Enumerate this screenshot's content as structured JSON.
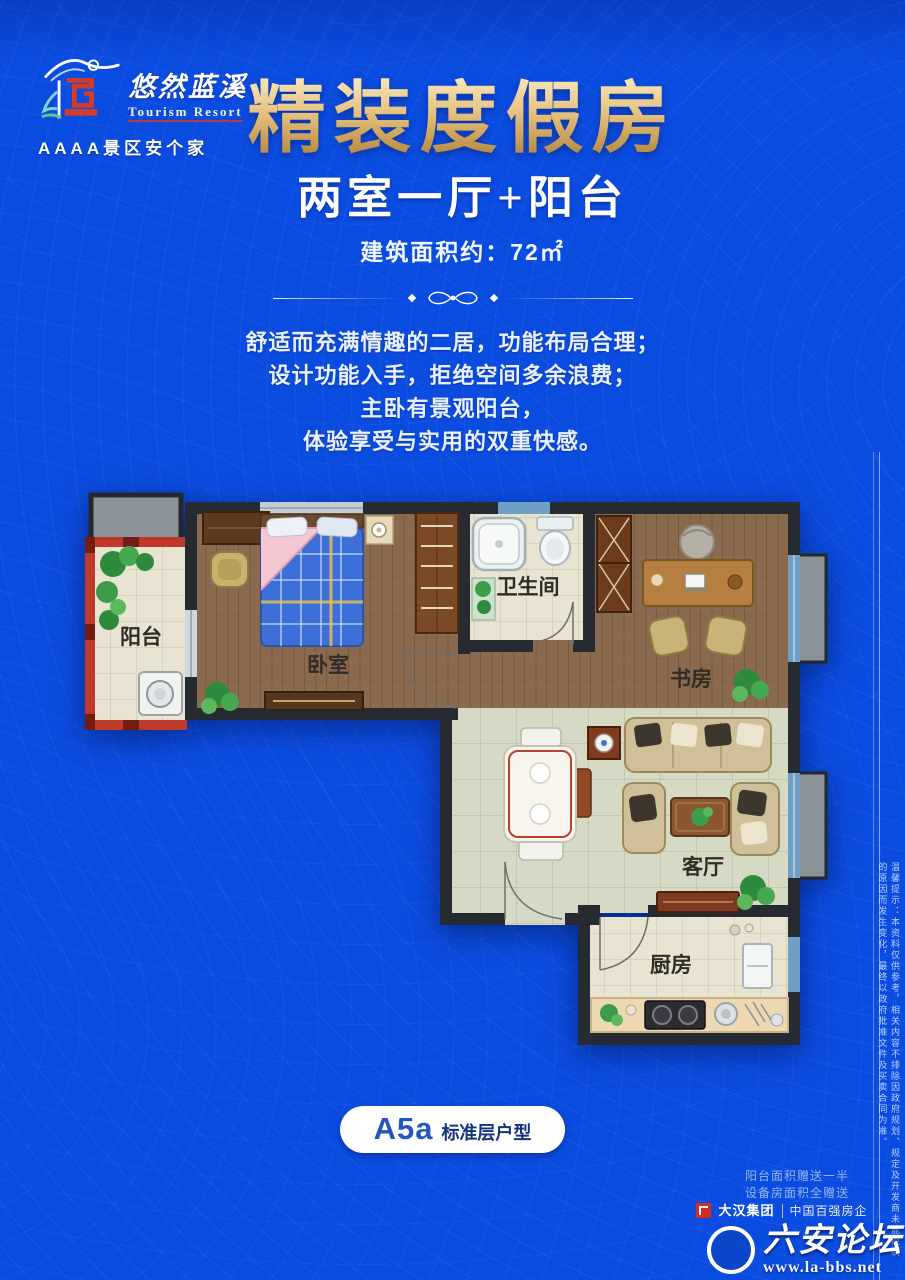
{
  "brand": {
    "logo_cn": "悠然蓝溪",
    "logo_en": "Tourism Resort",
    "tagline": "AAAA景区安个家"
  },
  "header": {
    "title": "精装度假房",
    "subtitle": "两室一厅+阳台",
    "area": "建筑面积约：72㎡"
  },
  "description": {
    "lines": [
      "舒适而充满情趣的二居，功能布局合理；",
      "设计功能入手，拒绝空间多余浪费；",
      "主卧有景观阳台，",
      "体验享受与实用的双重快感。"
    ]
  },
  "floorplan": {
    "rooms": {
      "balcony": "阳台",
      "bedroom": "卧室",
      "bathroom": "卫生间",
      "study": "书房",
      "living": "客厅",
      "kitchen": "厨房"
    }
  },
  "badge": {
    "code": "A5a",
    "label": "标准层户型"
  },
  "footer": {
    "note1": "阳台面积赠送一半",
    "note2": "设备房面积全赠送",
    "developer": "大汉集团",
    "developer_tag": "中国百强房企",
    "disclaimer": "温馨提示：本资料仅供参考，相关内容不排除因政府规划、规定及开发商未能控制的原因而发生变化，最终以政府批准文件及买卖合同为准。"
  },
  "watermark": {
    "site": "六安论坛",
    "url": "www.la-bbs.net"
  },
  "colors": {
    "background": "#0b4ce0",
    "title_gold": "#e0b873",
    "wall": "#262b31",
    "balcony_red": "#c03a2b",
    "wood_floor": "#8a6a4e",
    "tile_beige": "#e9e4d2",
    "tile_green": "#d6d9c3",
    "badge_text": "#2456bf"
  }
}
